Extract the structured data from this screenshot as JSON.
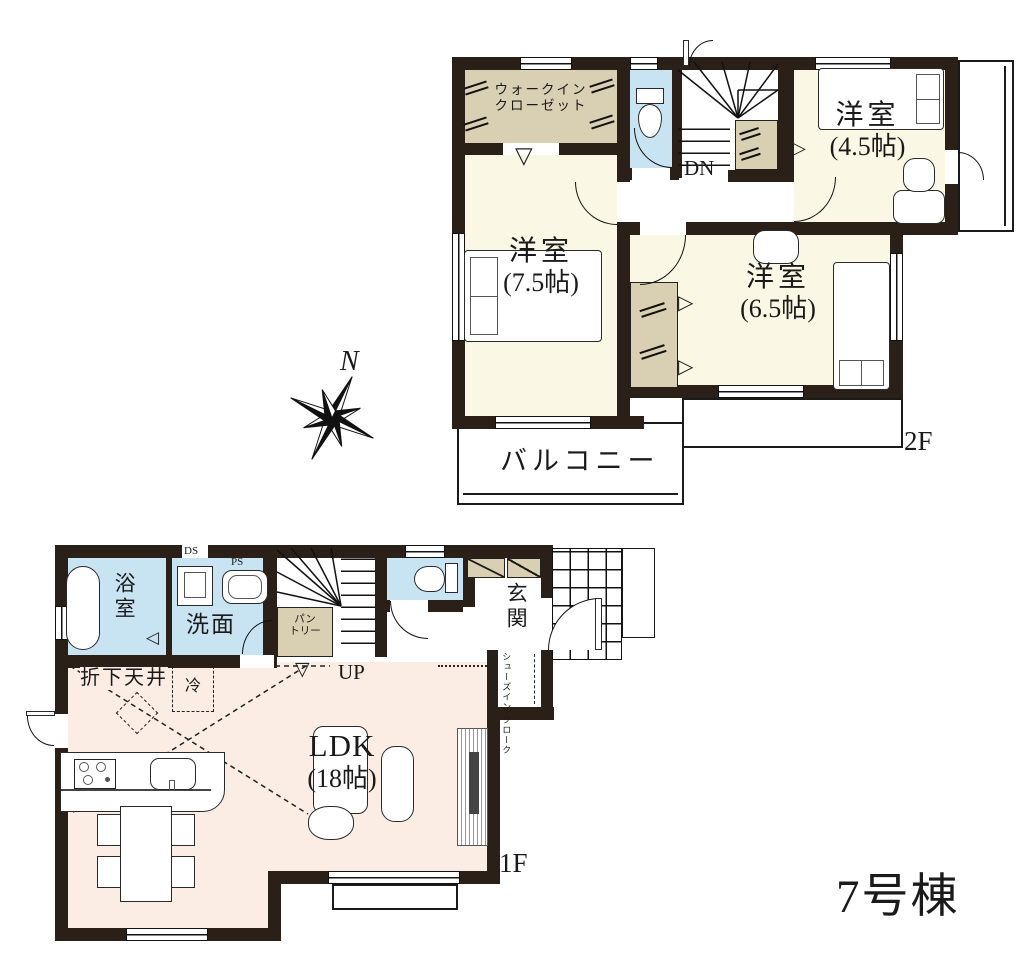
{
  "title": {
    "building_no": "7号棟"
  },
  "compass": {
    "north": "N"
  },
  "floor2": {
    "floor_label": "2F",
    "balcony_label": "バルコニー",
    "stairs_label": "DN",
    "walk_in_closet_line1": "ウォークイン",
    "walk_in_closet_line2": "クローゼット",
    "bedroom_a": {
      "name": "洋室",
      "size": "(7.5帖)"
    },
    "bedroom_b": {
      "name": "洋室",
      "size": "(4.5帖)"
    },
    "bedroom_c": {
      "name": "洋室",
      "size": "(6.5帖)"
    }
  },
  "floor1": {
    "floor_label": "1F",
    "stairs_label": "UP",
    "bath": "浴室",
    "washroom": "洗面",
    "pantry_line1": "パン",
    "pantry_line2": "トリー",
    "entrance": "玄関",
    "shoes_closet_line1": "シューズイン",
    "shoes_closet_line2": "クローク",
    "ldk": {
      "name": "LDK",
      "size": "(18帖)"
    },
    "dropped_ceiling": "折下天井",
    "refrigerator": "冷",
    "duct_space": "DS",
    "pipe_space": "PS"
  },
  "icons": {
    "triangle_right": "▷",
    "triangle_left": "◁",
    "triangle_down": "▽"
  },
  "colors": {
    "wall": "#2b2017",
    "room_cream": "#faf7e4",
    "closet_tan": "#d9cfb2",
    "wet_blue": "#c8e4f3",
    "ldk_peach": "#fbece4",
    "line": "#1a1a1a"
  }
}
